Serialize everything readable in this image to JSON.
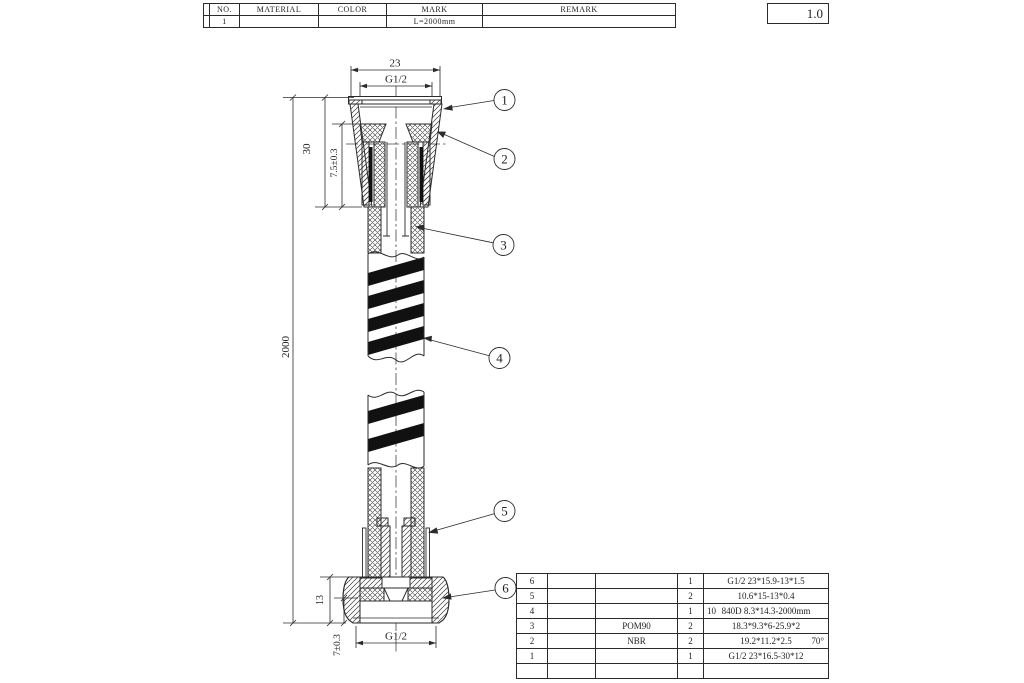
{
  "top_table": {
    "headers": {
      "c0": "",
      "c1": "NO.",
      "c2": "MATERIAL",
      "c3": "COLOR",
      "c4": "MARK",
      "c5": "REMARK"
    },
    "row": {
      "c0": "",
      "c1": "1",
      "c2": "",
      "c3": "",
      "c4": "L=2000mm",
      "c5": ""
    }
  },
  "version_box": {
    "value": "1.0"
  },
  "dimensions": {
    "top_width": "23",
    "top_thread": "G1/2",
    "upper_nut_height": "30",
    "upper_insert_depth": "7.5±0.3",
    "hose_length": "2000",
    "lower_nut_height": "13",
    "lower_insert_depth": "7±0.3",
    "bottom_thread": "G1/2"
  },
  "callouts": {
    "c1": "1",
    "c2": "2",
    "c3": "3",
    "c4": "4",
    "c5": "5",
    "c6": "6"
  },
  "parts_table": {
    "rows": [
      {
        "no": "6",
        "name": "",
        "material": "",
        "qty": "1",
        "remark_prefix": "",
        "remark": "G1/2 23*15.9-13*1.5",
        "remark_suffix": ""
      },
      {
        "no": "5",
        "name": "",
        "material": "",
        "qty": "2",
        "remark_prefix": "",
        "remark": "10.6*15-13*0.4",
        "remark_suffix": ""
      },
      {
        "no": "4",
        "name": "",
        "material": "",
        "qty": "1",
        "remark_prefix": "10",
        "remark": "840D 8.3*14.3-2000mm",
        "remark_suffix": ""
      },
      {
        "no": "3",
        "name": "",
        "material": "POM90",
        "qty": "2",
        "remark_prefix": "",
        "remark": "18.3*9.3*6-25.9*2",
        "remark_suffix": ""
      },
      {
        "no": "2",
        "name": "",
        "material": "NBR",
        "qty": "2",
        "remark_prefix": "",
        "remark": "19.2*11.2*2.5",
        "remark_suffix": "70°"
      },
      {
        "no": "1",
        "name": "",
        "material": "",
        "qty": "1",
        "remark_prefix": "",
        "remark": "G1/2 23*16.5-30*12",
        "remark_suffix": ""
      },
      {
        "no": "",
        "name": "",
        "material": "",
        "qty": "",
        "remark_prefix": "",
        "remark": "",
        "remark_suffix": ""
      }
    ]
  },
  "colors": {
    "line": "#2b2b2b",
    "stripe": "#111111",
    "background": "#ffffff"
  }
}
